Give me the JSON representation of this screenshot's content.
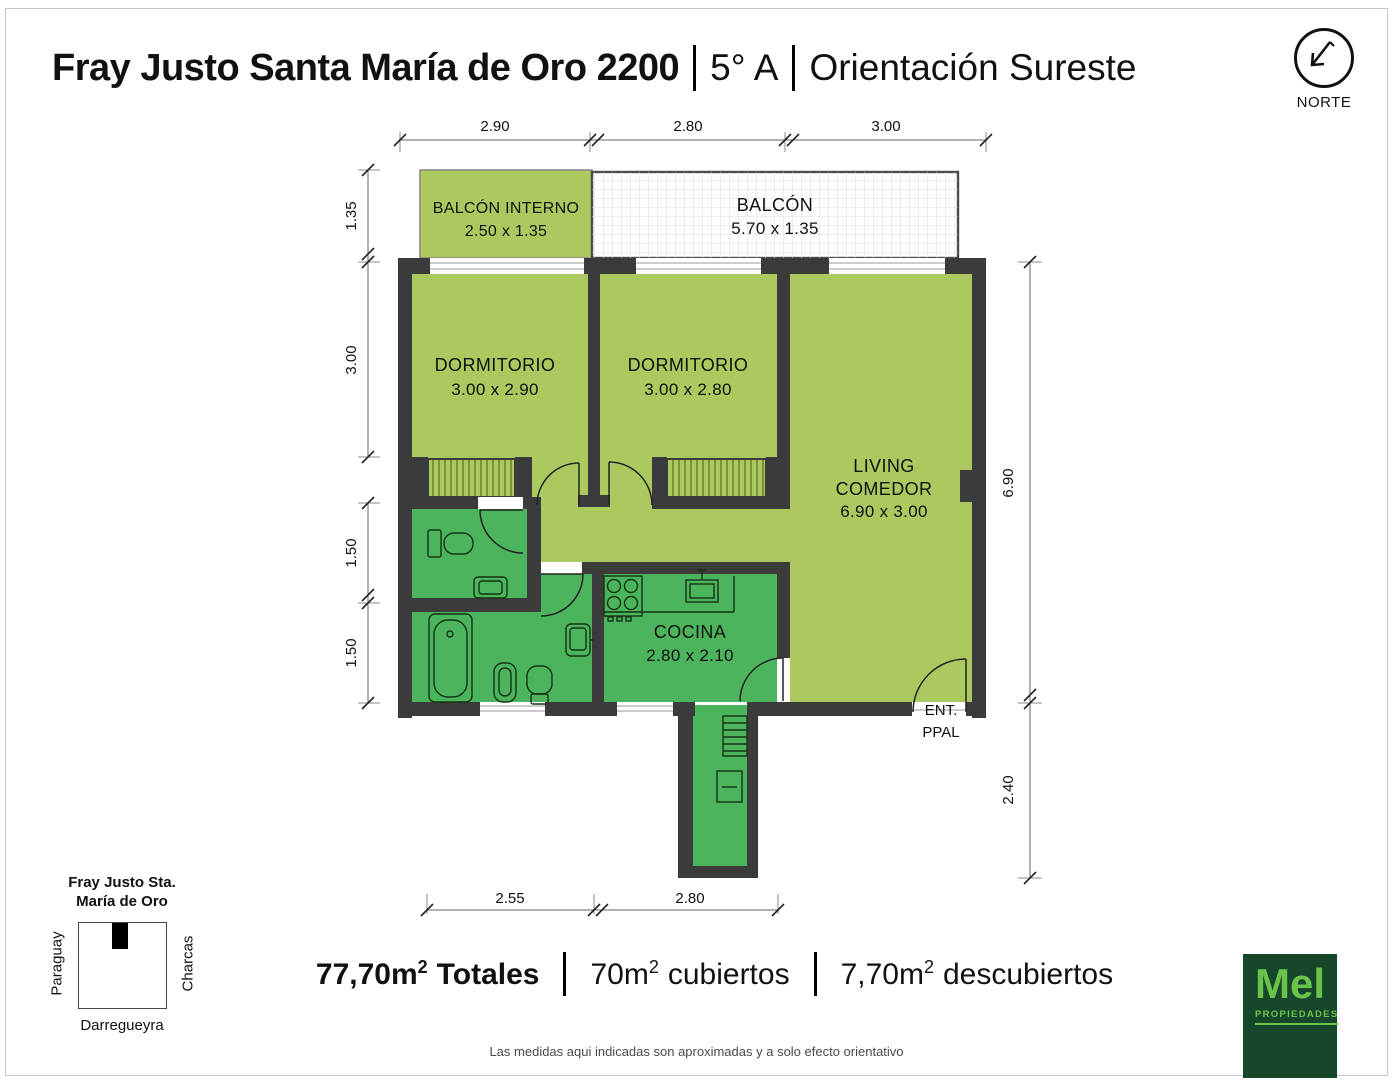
{
  "header": {
    "address": "Fray Justo Santa María de Oro 2200",
    "unit": "5° A",
    "orientation": "Orientación Sureste"
  },
  "compass": {
    "label": "NORTE"
  },
  "plan": {
    "rooms": {
      "balcon_interno": {
        "name": "BALCÓN INTERNO",
        "size": "2.50 x 1.35"
      },
      "balcon": {
        "name": "BALCÓN",
        "size": "5.70 x 1.35"
      },
      "dormitorio1": {
        "name": "DORMITORIO",
        "size": "3.00 x 2.90"
      },
      "dormitorio2": {
        "name": "DORMITORIO",
        "size": "3.00 x 2.80"
      },
      "living": {
        "line1": "LIVING",
        "line2": "COMEDOR",
        "size": "6.90 x 3.00"
      },
      "cocina": {
        "name": "COCINA",
        "size": "2.80 x 2.10"
      },
      "entrada": {
        "line1": "ENT.",
        "line2": "PPAL"
      }
    },
    "dims": {
      "top": [
        "2.90",
        "2.80",
        "3.00"
      ],
      "left": [
        "1.35",
        "3.00",
        "1.50",
        "1.50"
      ],
      "right": [
        "6.90",
        "2.40"
      ],
      "bottom": [
        "2.55",
        "2.80"
      ]
    }
  },
  "map": {
    "title1": "Fray Justo Sta.",
    "title2": "María de Oro",
    "street_left": "Paraguay",
    "street_right": "Charcas",
    "street_bottom": "Darregueyra"
  },
  "totals": {
    "items": [
      {
        "value": "77,70m",
        "sup": "2",
        "label": "Totales"
      },
      {
        "value": "70m",
        "sup": "2",
        "label": "cubiertos"
      },
      {
        "value": "7,70m",
        "sup": "2",
        "label": "descubiertos"
      }
    ]
  },
  "footer": {
    "disclaimer": "Las medidas aqui indicadas son aproximadas y a solo efecto orientativo"
  },
  "logo": {
    "name": "Mel",
    "sub": "PROPIEDADES"
  },
  "colors": {
    "room_light": "#abc95e",
    "room_service": "#4cb45c",
    "wall": "#3b3b3b",
    "logo_bg": "#17472a",
    "logo_green": "#6cc34a"
  }
}
